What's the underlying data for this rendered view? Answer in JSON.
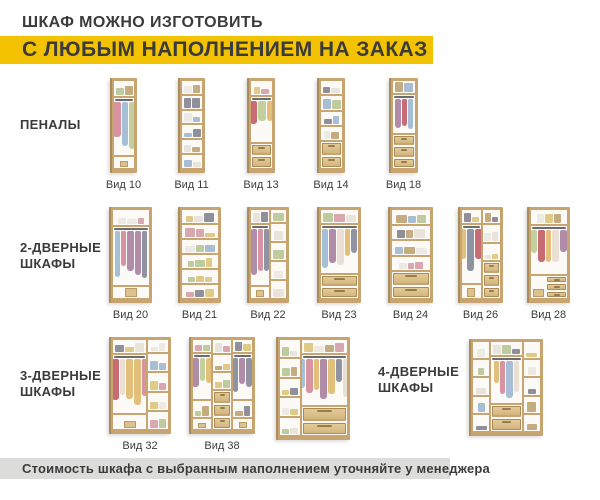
{
  "header": {
    "line1": "ШКАФ МОЖНО ИЗГОТОВИТЬ",
    "line2": "С ЛЮБЫМ НАПОЛНЕНИЕМ НА ЗАКАЗ"
  },
  "footer": {
    "text": "Стоимость шкафа с выбранным наполнением уточняйте у менеджера"
  },
  "colors": {
    "accent_yellow": "#F3C200",
    "text_dark": "#3B3B3D",
    "footer_bg": "#DCDCDA",
    "wood_frame": "#C7A470",
    "wood_side": "#AB8C5C",
    "drawer_light": "#E2CB97",
    "drawer_dark": "#D3B67F",
    "drawer_border": "#AB8A55",
    "interior": "#FBFAF7",
    "rod": "#6B6B70"
  },
  "palettes": {
    "shelf_items": [
      "#ECEAE3",
      "#A9BED3",
      "#D8A7B0",
      "#C4AB80",
      "#90909B",
      "#BECB9E",
      "#DFCA88",
      "#E8E4DB"
    ],
    "garments": [
      "#D793A0",
      "#9094A2",
      "#A6BED6",
      "#C3CF9E",
      "#C76B74",
      "#E2C07C",
      "#B08CA8",
      "#EADFD2"
    ]
  },
  "sections": [
    {
      "id": "penaly",
      "lines": [
        "ПЕНАЛЫ"
      ],
      "x": 20,
      "y": 117
    },
    {
      "id": "2-door",
      "lines": [
        "2-ДВЕРНЫЕ",
        "ШКАФЫ"
      ],
      "x": 20,
      "y": 240
    },
    {
      "id": "3-door",
      "lines": [
        "3-ДВЕРНЫЕ",
        "ШКАФЫ"
      ],
      "x": 20,
      "y": 368
    },
    {
      "id": "4-door",
      "lines": [
        "4-ДВЕРНЫЕ",
        "ШКАФЫ"
      ],
      "x": 378,
      "y": 364
    }
  ],
  "wardrobes": [
    {
      "label": "Вид 10",
      "x": 110,
      "y": 78,
      "w": 27,
      "h": 95,
      "cols": [
        {
          "w": 1,
          "cells": [
            [
              "sh",
              1.5
            ],
            [
              "hg",
              6.3
            ],
            [
              "fl",
              1.2
            ]
          ]
        }
      ]
    },
    {
      "label": "Вид 11",
      "x": 178,
      "y": 78,
      "w": 27,
      "h": 95,
      "cols": [
        {
          "w": 1,
          "cells": [
            [
              "sh",
              1
            ],
            [
              "sh",
              1
            ],
            [
              "sh",
              1
            ],
            [
              "sh",
              1
            ],
            [
              "sh",
              1
            ],
            [
              "sh",
              1
            ]
          ]
        }
      ]
    },
    {
      "label": "Вид 13",
      "x": 247,
      "y": 78,
      "w": 28,
      "h": 95,
      "cols": [
        {
          "w": 1,
          "cells": [
            [
              "sh",
              1.4
            ],
            [
              "hg",
              4.8
            ],
            [
              "dr",
              0.9
            ],
            [
              "dr",
              0.9
            ]
          ]
        }
      ]
    },
    {
      "label": "Вид 14",
      "x": 317,
      "y": 78,
      "w": 28,
      "h": 95,
      "cols": [
        {
          "w": 1,
          "cells": [
            [
              "sh",
              1.1
            ],
            [
              "sh",
              1.1
            ],
            [
              "sh",
              1.1
            ],
            [
              "sh",
              1.1
            ],
            [
              "dr",
              0.8
            ],
            [
              "dr",
              0.8
            ]
          ]
        }
      ]
    },
    {
      "label": "Вид 18",
      "x": 389,
      "y": 78,
      "w": 29,
      "h": 95,
      "cols": [
        {
          "w": 1,
          "cells": [
            [
              "sh",
              1.3
            ],
            [
              "hg",
              4.3
            ],
            [
              "dr",
              0.8
            ],
            [
              "dr",
              0.8
            ],
            [
              "dr",
              0.8
            ]
          ]
        }
      ]
    },
    {
      "label": "Вид 20",
      "x": 109,
      "y": 207,
      "w": 43,
      "h": 96,
      "cols": [
        {
          "w": 1,
          "cells": [
            [
              "sh",
              1.5
            ],
            [
              "hg",
              6.3
            ],
            [
              "fl",
              1.2
            ]
          ]
        }
      ]
    },
    {
      "label": "Вид 21",
      "x": 178,
      "y": 207,
      "w": 43,
      "h": 96,
      "cols": [
        {
          "w": 1,
          "cells": [
            [
              "sh",
              1
            ],
            [
              "sh",
              1
            ],
            [
              "sh",
              1
            ],
            [
              "sh",
              1
            ],
            [
              "sh",
              1
            ],
            [
              "sh",
              1
            ]
          ]
        }
      ]
    },
    {
      "label": "Вид 22",
      "x": 247,
      "y": 207,
      "w": 42,
      "h": 96,
      "cols": [
        {
          "w": 0.55,
          "cells": [
            [
              "sh",
              1.2
            ],
            [
              "hg",
              6.4
            ],
            [
              "fl",
              1.2
            ]
          ]
        },
        {
          "w": 0.45,
          "cells": [
            [
              "sh",
              1.2
            ],
            [
              "sh",
              1.9
            ],
            [
              "sh",
              1.9
            ],
            [
              "sh",
              1.9
            ],
            [
              "sh",
              1.9
            ]
          ]
        }
      ]
    },
    {
      "label": "Вид 23",
      "x": 317,
      "y": 207,
      "w": 44,
      "h": 96,
      "cols": [
        {
          "w": 1,
          "cells": [
            [
              "sh",
              1.4
            ],
            [
              "hg",
              5.4
            ],
            [
              "dr",
              0.9
            ],
            [
              "dr",
              0.9
            ]
          ]
        }
      ]
    },
    {
      "label": "Вид 24",
      "x": 388,
      "y": 207,
      "w": 45,
      "h": 96,
      "cols": [
        {
          "w": 1,
          "cells": [
            [
              "sh",
              1.15
            ],
            [
              "sh",
              1.15
            ],
            [
              "sh",
              1.15
            ],
            [
              "sh",
              1.15
            ],
            [
              "dr",
              0.85
            ],
            [
              "dr",
              0.85
            ]
          ]
        }
      ]
    },
    {
      "label": "Вид 26",
      "x": 458,
      "y": 207,
      "w": 45,
      "h": 96,
      "cols": [
        {
          "w": 0.52,
          "cells": [
            [
              "sh",
              1.2
            ],
            [
              "hg",
              6.2
            ],
            [
              "fl",
              1.4
            ]
          ]
        },
        {
          "w": 0.48,
          "cells": [
            [
              "sh",
              1.2
            ],
            [
              "sh",
              1.6
            ],
            [
              "sh",
              1.6
            ],
            [
              "dr",
              0.8
            ],
            [
              "dr",
              0.8
            ],
            [
              "dr",
              0.8
            ]
          ]
        }
      ]
    },
    {
      "label": "Вид 28",
      "x": 527,
      "y": 207,
      "w": 43,
      "h": 96,
      "cols": [
        {
          "w": 1,
          "cells": [
            [
              "sh",
              1.3
            ],
            [
              "hg",
              5
            ],
            [
              "d3",
              2.5
            ]
          ]
        }
      ]
    },
    {
      "label": "Вид 32",
      "x": 109,
      "y": 337,
      "w": 62,
      "h": 97,
      "cols": [
        {
          "w": 0.63,
          "cells": [
            [
              "sh",
              1.2
            ],
            [
              "hg",
              5.8
            ],
            [
              "fl",
              1.4
            ]
          ]
        },
        {
          "w": 0.37,
          "cells": [
            [
              "sh",
              1.2
            ],
            [
              "sh",
              1.8
            ],
            [
              "sh",
              1.8
            ],
            [
              "sh",
              1.8
            ],
            [
              "sh",
              1.8
            ]
          ]
        }
      ]
    },
    {
      "label": "Вид 38",
      "x": 189,
      "y": 337,
      "w": 66,
      "h": 97,
      "cols": [
        {
          "w": 0.33,
          "cells": [
            [
              "sh",
              1.2
            ],
            [
              "hg",
              4.8
            ],
            [
              "sh",
              1.6
            ],
            [
              "fl",
              1.1
            ]
          ]
        },
        {
          "w": 0.33,
          "cells": [
            [
              "sh",
              1.2
            ],
            [
              "sh",
              1.5
            ],
            [
              "sh",
              1.5
            ],
            [
              "dr",
              0.85
            ],
            [
              "dr",
              0.85
            ],
            [
              "dr",
              0.85
            ]
          ]
        },
        {
          "w": 0.34,
          "cells": [
            [
              "sh",
              1.2
            ],
            [
              "hg",
              4.8
            ],
            [
              "sh",
              1.6
            ],
            [
              "fl",
              1.1
            ]
          ]
        }
      ]
    },
    {
      "label": "",
      "x": 276,
      "y": 337,
      "w": 74,
      "h": 103,
      "cols": [
        {
          "w": 0.3,
          "cells": [
            [
              "sh",
              1.3
            ],
            [
              "sh",
              1.3
            ],
            [
              "sh",
              1.3
            ],
            [
              "sh",
              1.3
            ],
            [
              "sh",
              1.3
            ]
          ]
        },
        {
          "w": 0.7,
          "cells": [
            [
              "sh",
              1.2
            ],
            [
              "hg",
              4.8
            ],
            [
              "dr",
              1
            ],
            [
              "dr",
              1
            ]
          ]
        }
      ]
    },
    {
      "label": "",
      "x": 469,
      "y": 339,
      "w": 74,
      "h": 97,
      "cols": [
        {
          "w": 0.26,
          "cells": [
            [
              "sh",
              1.3
            ],
            [
              "sh",
              1.3
            ],
            [
              "sh",
              1.3
            ],
            [
              "sh",
              1.3
            ],
            [
              "sh",
              1.3
            ]
          ]
        },
        {
          "w": 0.48,
          "cells": [
            [
              "sh",
              1.2
            ],
            [
              "hg",
              4.8
            ],
            [
              "dr",
              1
            ],
            [
              "dr",
              1
            ]
          ]
        },
        {
          "w": 0.26,
          "cells": [
            [
              "sh",
              1.3
            ],
            [
              "sh",
              1.3
            ],
            [
              "sh",
              1.3
            ],
            [
              "sh",
              1.3
            ],
            [
              "sh",
              1.3
            ]
          ]
        }
      ]
    }
  ]
}
